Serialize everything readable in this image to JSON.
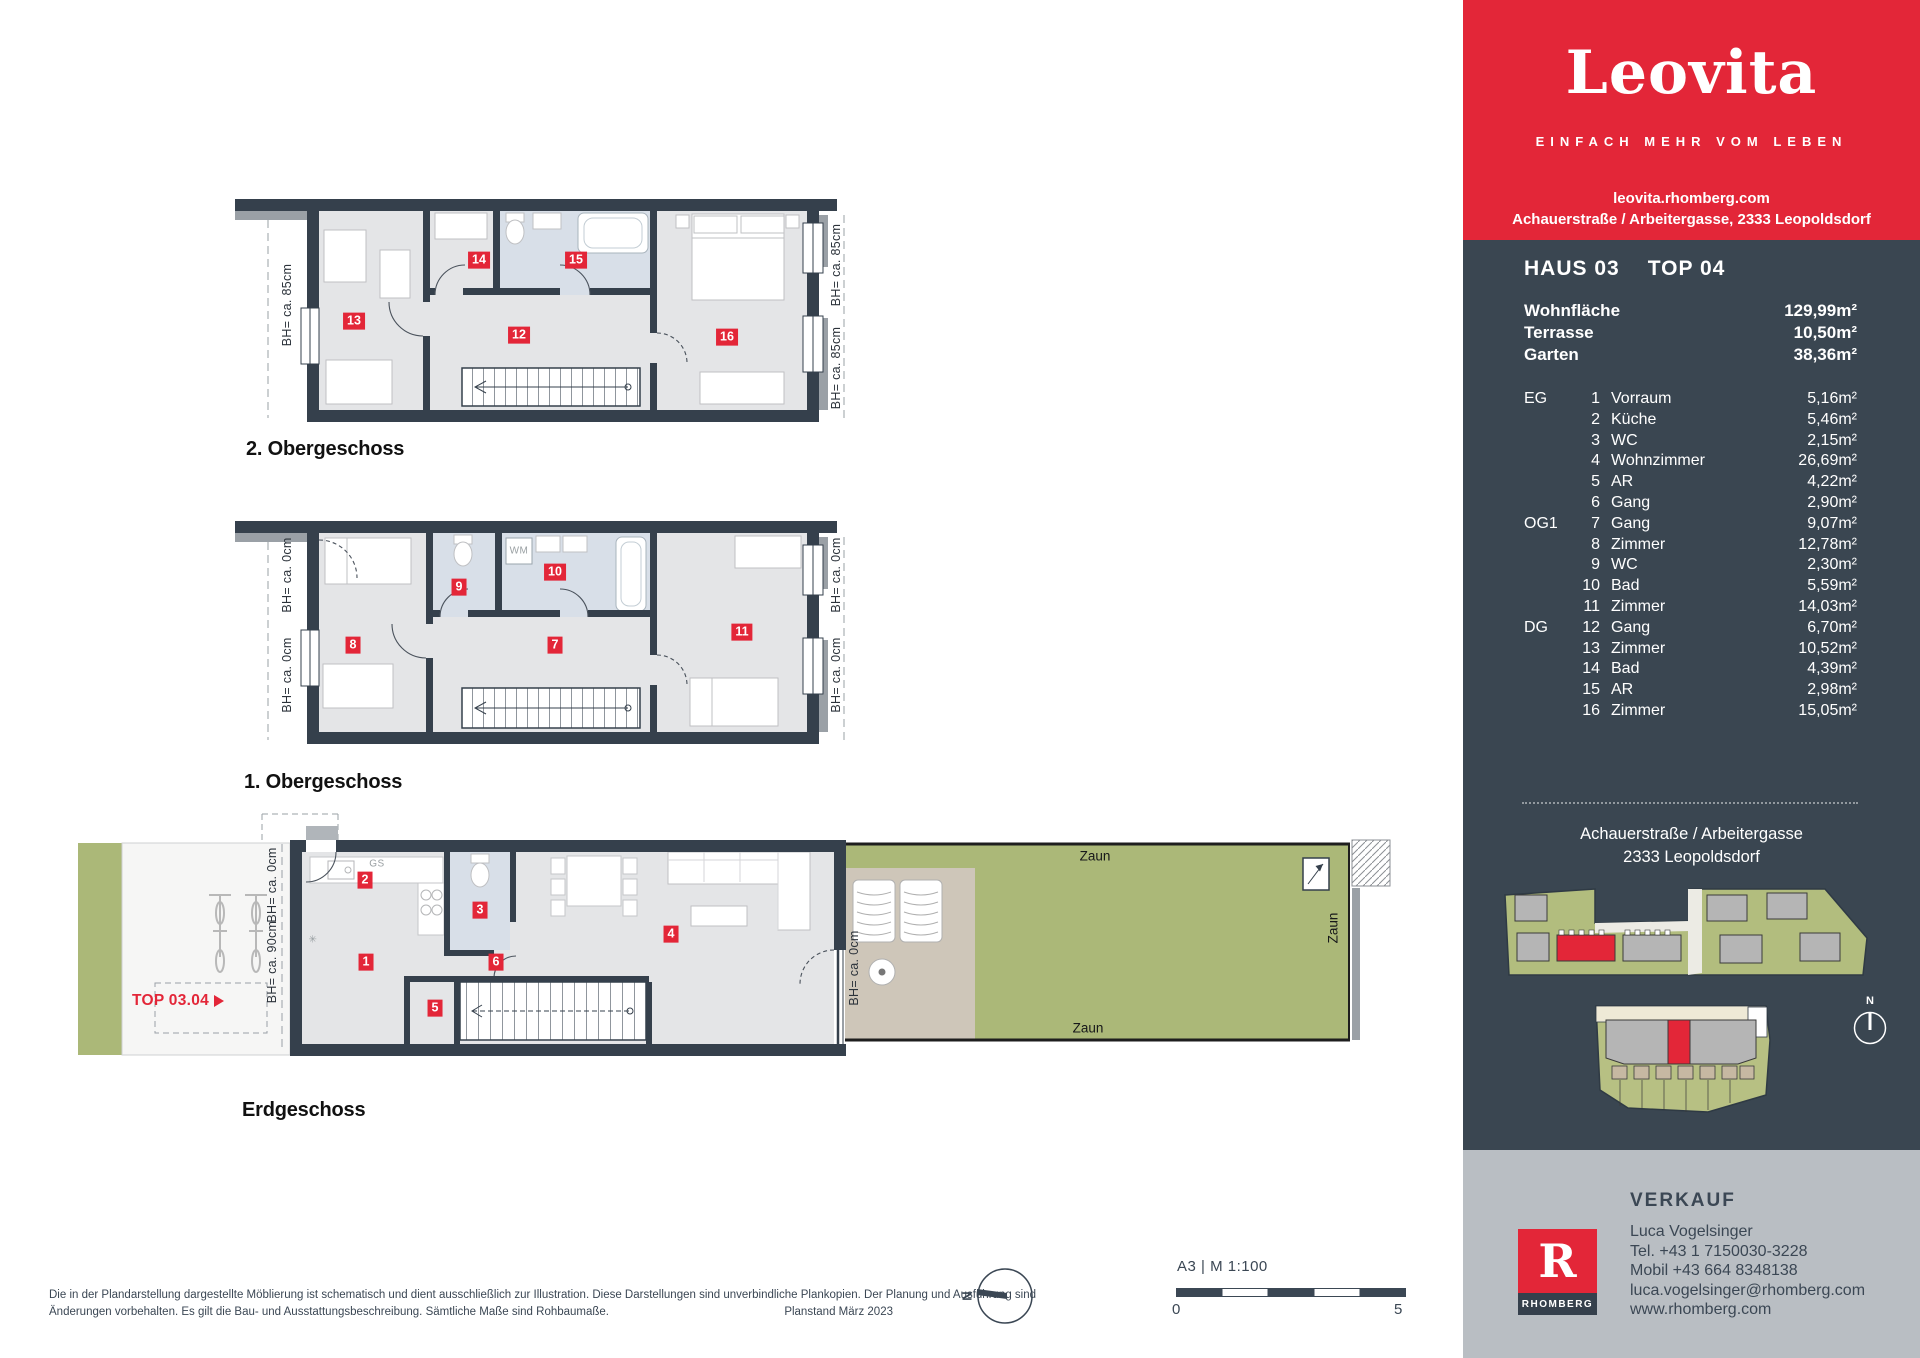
{
  "brand": {
    "logo": "Leovita",
    "tagline": "EINFACH MEHR VOM LEBEN",
    "website": "leovita.rhomberg.com",
    "address_line": "Achauerstraße / Arbeitergasse, 2333 Leopoldsdorf",
    "colors": {
      "red": "#e32638",
      "navy": "#3a4651",
      "gray_panel": "#b9bec3"
    }
  },
  "unit": {
    "haus": "HAUS 03",
    "top": "TOP 04",
    "summary": [
      {
        "label": "Wohnfläche",
        "value": "129,99m²"
      },
      {
        "label": "Terrasse",
        "value": "10,50m²"
      },
      {
        "label": "Garten",
        "value": "38,36m²"
      }
    ],
    "rooms": [
      {
        "floor": "EG",
        "nr": "1",
        "name": "Vorraum",
        "area": "5,16m²"
      },
      {
        "floor": "",
        "nr": "2",
        "name": "Küche",
        "area": "5,46m²"
      },
      {
        "floor": "",
        "nr": "3",
        "name": "WC",
        "area": "2,15m²"
      },
      {
        "floor": "",
        "nr": "4",
        "name": "Wohnzimmer",
        "area": "26,69m²"
      },
      {
        "floor": "",
        "nr": "5",
        "name": "AR",
        "area": "4,22m²"
      },
      {
        "floor": "",
        "nr": "6",
        "name": "Gang",
        "area": "2,90m²"
      },
      {
        "floor": "OG1",
        "nr": "7",
        "name": "Gang",
        "area": "9,07m²"
      },
      {
        "floor": "",
        "nr": "8",
        "name": "Zimmer",
        "area": "12,78m²"
      },
      {
        "floor": "",
        "nr": "9",
        "name": "WC",
        "area": "2,30m²"
      },
      {
        "floor": "",
        "nr": "10",
        "name": "Bad",
        "area": "5,59m²"
      },
      {
        "floor": "",
        "nr": "11",
        "name": "Zimmer",
        "area": "14,03m²"
      },
      {
        "floor": "DG",
        "nr": "12",
        "name": "Gang",
        "area": "6,70m²"
      },
      {
        "floor": "",
        "nr": "13",
        "name": "Zimmer",
        "area": "10,52m²"
      },
      {
        "floor": "",
        "nr": "14",
        "name": "Bad",
        "area": "4,39m²"
      },
      {
        "floor": "",
        "nr": "15",
        "name": "AR",
        "area": "2,98m²"
      },
      {
        "floor": "",
        "nr": "16",
        "name": "Zimmer",
        "area": "15,05m²"
      }
    ],
    "location1": "Achauerstraße / Arbeitergasse",
    "location2": "2333 Leopoldsdorf",
    "compass_north": "N"
  },
  "plans": {
    "og2": {
      "label": "2. Obergeschoss",
      "badges": [
        {
          "n": "13",
          "x": 124,
          "y": 131
        },
        {
          "n": "14",
          "x": 249,
          "y": 70
        },
        {
          "n": "15",
          "x": 346,
          "y": 70
        },
        {
          "n": "12",
          "x": 289,
          "y": 145
        },
        {
          "n": "16",
          "x": 497,
          "y": 147
        }
      ],
      "bh_labels": [
        {
          "t": "BH= ca. 85cm",
          "x": 57,
          "y": 115
        },
        {
          "t": "BH= ca. 85cm",
          "x": 606,
          "y": 75
        },
        {
          "t": "BH= ca. 85cm",
          "x": 606,
          "y": 178
        }
      ],
      "annotations": []
    },
    "og1": {
      "label": "1. Obergeschoss",
      "badges": [
        {
          "n": "8",
          "x": 123,
          "y": 133
        },
        {
          "n": "9",
          "x": 229,
          "y": 75
        },
        {
          "n": "10",
          "x": 325,
          "y": 60
        },
        {
          "n": "7",
          "x": 325,
          "y": 133
        },
        {
          "n": "11",
          "x": 512,
          "y": 120
        }
      ],
      "bh_labels": [
        {
          "t": "BH= ca. 0cm",
          "x": 57,
          "y": 63
        },
        {
          "t": "BH= ca. 0cm",
          "x": 57,
          "y": 163
        },
        {
          "t": "BH= ca. 0cm",
          "x": 606,
          "y": 63
        },
        {
          "t": "BH= ca. 0cm",
          "x": 606,
          "y": 163
        }
      ],
      "annotations": [
        {
          "t": "WM",
          "x": 289,
          "y": 39
        }
      ]
    },
    "eg": {
      "label": "Erdgeschoss",
      "top_label": "TOP 03.04",
      "badges": [
        {
          "n": "2",
          "x": 295,
          "y": 80
        },
        {
          "n": "3",
          "x": 410,
          "y": 110
        },
        {
          "n": "1",
          "x": 296,
          "y": 162
        },
        {
          "n": "6",
          "x": 426,
          "y": 162
        },
        {
          "n": "5",
          "x": 365,
          "y": 208
        },
        {
          "n": "4",
          "x": 601,
          "y": 134
        }
      ],
      "bh_labels": [
        {
          "t": "BH= ca. 0cm",
          "x": 202,
          "y": 85
        },
        {
          "t": "BH= ca. 90cm",
          "x": 202,
          "y": 162
        },
        {
          "t": "BH= ca. 0cm",
          "x": 784,
          "y": 168
        }
      ],
      "zaun": [
        {
          "t": "Zaun",
          "x": 1025,
          "y": 56,
          "rot": false
        },
        {
          "t": "Zaun",
          "x": 1018,
          "y": 228,
          "rot": false
        },
        {
          "t": "Zaun",
          "x": 1263,
          "y": 128,
          "rot": true
        }
      ],
      "annotations": [
        {
          "t": "GS",
          "x": 307,
          "y": 64
        },
        {
          "t": "✳",
          "x": 243,
          "y": 140
        }
      ]
    }
  },
  "verkauf": {
    "title": "VERKAUF",
    "logo_letter": "R",
    "logo_text": "RHOMBERG",
    "name": "Luca Vogelsinger",
    "tel": "Tel. +43 1 7150030-3228",
    "mobil": "Mobil +43 664 8348138",
    "email": "luca.vogelsinger@rhomberg.com",
    "web": "www.rhomberg.com"
  },
  "footer": {
    "line1": "Die in der Plandarstellung dargestellte Möblierung ist schematisch und dient ausschließlich zur Illustration. Diese Darstellungen sind unverbindliche Plankopien. Der Planung und Ausführung sind",
    "line2": "Änderungen vorbehalten. Es gilt die Bau- und Ausstattungsbeschreibung. Sämtliche Maße sind Rohbaumaße.",
    "planstand": "Planstand März 2023",
    "sheet": "A3 | M 1:100",
    "scale_zero": "0",
    "scale_five": "5",
    "compass_north": "N"
  }
}
